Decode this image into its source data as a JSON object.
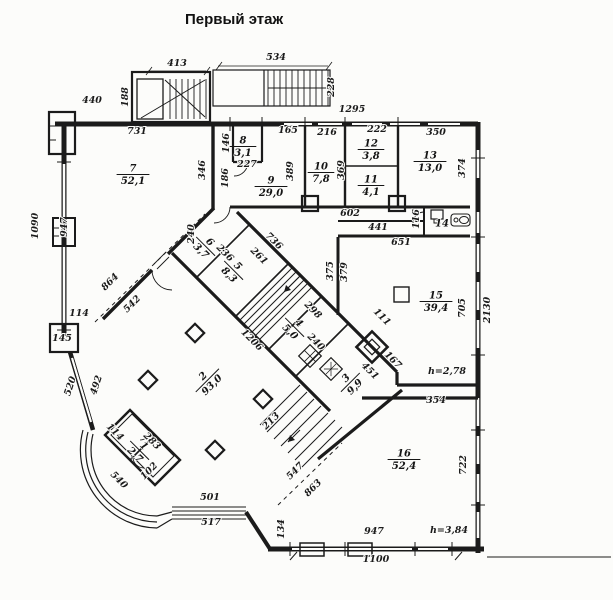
{
  "title": "Первый этаж",
  "plan": {
    "rooms": [
      {
        "num": "7",
        "area": "52,1",
        "x": 133,
        "y": 174,
        "r": 0
      },
      {
        "num": "8",
        "area": "3,1",
        "x": 243,
        "y": 146,
        "r": 0
      },
      {
        "num": "9",
        "area": "29,0",
        "x": 271,
        "y": 186,
        "r": 0
      },
      {
        "num": "10",
        "area": "7,8",
        "x": 321,
        "y": 172,
        "r": 0
      },
      {
        "num": "12",
        "area": "3,8",
        "x": 371,
        "y": 149,
        "r": 0
      },
      {
        "num": "11",
        "area": "4,1",
        "x": 371,
        "y": 185,
        "r": 0
      },
      {
        "num": "13",
        "area": "13,0",
        "x": 430,
        "y": 161,
        "r": 0
      },
      {
        "num": "14",
        "area": "",
        "x": 442,
        "y": 229,
        "r": 0
      },
      {
        "num": "15",
        "area": "39,4",
        "x": 436,
        "y": 301,
        "r": 0
      },
      {
        "num": "16",
        "area": "52,4",
        "x": 404,
        "y": 459,
        "r": 0
      },
      {
        "num": "6",
        "area": "3,7",
        "x": 206,
        "y": 246,
        "r": 45
      },
      {
        "num": "5",
        "area": "8,3",
        "x": 234,
        "y": 270,
        "r": 45
      },
      {
        "num": "4",
        "area": "5,0",
        "x": 295,
        "y": 327,
        "r": 45
      },
      {
        "num": "3",
        "area": "9,9",
        "x": 350,
        "y": 382,
        "r": -45
      },
      {
        "num": "2",
        "area": "93,0",
        "x": 207,
        "y": 380,
        "r": -45
      },
      {
        "num": "1",
        "area": "2,7",
        "x": 140,
        "y": 450,
        "r": 45
      }
    ],
    "dimensions": [
      {
        "t": "413",
        "x": 177,
        "y": 66,
        "r": 0
      },
      {
        "t": "188",
        "x": 128,
        "y": 97,
        "r": -90
      },
      {
        "t": "440",
        "x": 92,
        "y": 103,
        "r": 0
      },
      {
        "t": "534",
        "x": 276,
        "y": 60,
        "r": 0
      },
      {
        "t": "228",
        "x": 334,
        "y": 87,
        "r": -90
      },
      {
        "t": "1295",
        "x": 352,
        "y": 112,
        "r": 0
      },
      {
        "t": "731",
        "x": 137,
        "y": 134,
        "r": 0
      },
      {
        "t": "165",
        "x": 288,
        "y": 133,
        "r": 0
      },
      {
        "t": "216",
        "x": 327,
        "y": 135,
        "r": 0
      },
      {
        "t": "222",
        "x": 377,
        "y": 132,
        "r": 0
      },
      {
        "t": "350",
        "x": 436,
        "y": 135,
        "r": 0
      },
      {
        "t": "346",
        "x": 205,
        "y": 170,
        "r": -90
      },
      {
        "t": "146",
        "x": 229,
        "y": 143,
        "r": -90
      },
      {
        "t": "186",
        "x": 228,
        "y": 178,
        "r": -90
      },
      {
        "t": "227",
        "x": 247,
        "y": 167,
        "r": 0
      },
      {
        "t": "389",
        "x": 293,
        "y": 171,
        "r": -90
      },
      {
        "t": "369",
        "x": 344,
        "y": 170,
        "r": -90
      },
      {
        "t": "374",
        "x": 465,
        "y": 168,
        "r": -90
      },
      {
        "t": "602",
        "x": 350,
        "y": 216,
        "r": 0
      },
      {
        "t": "441",
        "x": 378,
        "y": 230,
        "r": 0
      },
      {
        "t": "651",
        "x": 401,
        "y": 245,
        "r": 0
      },
      {
        "t": "116",
        "x": 419,
        "y": 219,
        "r": -90
      },
      {
        "t": "375",
        "x": 333,
        "y": 271,
        "r": -90
      },
      {
        "t": "379",
        "x": 347,
        "y": 272,
        "r": -90
      },
      {
        "t": "1090",
        "x": 38,
        "y": 226,
        "r": -90
      },
      {
        "t": "947",
        "x": 67,
        "y": 227,
        "r": -90
      },
      {
        "t": "114",
        "x": 79,
        "y": 316,
        "r": 0
      },
      {
        "t": "145",
        "x": 62,
        "y": 341,
        "r": 0
      },
      {
        "t": "864",
        "x": 112,
        "y": 284,
        "r": -45
      },
      {
        "t": "542",
        "x": 134,
        "y": 306,
        "r": -45
      },
      {
        "t": "736",
        "x": 272,
        "y": 243,
        "r": 45
      },
      {
        "t": "240",
        "x": 194,
        "y": 234,
        "r": -90
      },
      {
        "t": "236",
        "x": 223,
        "y": 255,
        "r": 45
      },
      {
        "t": "261",
        "x": 257,
        "y": 258,
        "r": 45
      },
      {
        "t": "298",
        "x": 311,
        "y": 312,
        "r": 45
      },
      {
        "t": "240",
        "x": 314,
        "y": 344,
        "r": 45
      },
      {
        "t": "1206",
        "x": 250,
        "y": 342,
        "r": 45
      },
      {
        "t": "520",
        "x": 73,
        "y": 387,
        "r": -72
      },
      {
        "t": "492",
        "x": 99,
        "y": 386,
        "r": -72
      },
      {
        "t": "114",
        "x": 113,
        "y": 434,
        "r": 45
      },
      {
        "t": "283",
        "x": 150,
        "y": 443,
        "r": 45
      },
      {
        "t": "540",
        "x": 117,
        "y": 482,
        "r": 45
      },
      {
        "t": "102",
        "x": 151,
        "y": 473,
        "r": -45
      },
      {
        "t": "501",
        "x": 210,
        "y": 500,
        "r": 0
      },
      {
        "t": "517",
        "x": 211,
        "y": 525,
        "r": 0
      },
      {
        "t": "213",
        "x": 273,
        "y": 423,
        "r": -45
      },
      {
        "t": "547",
        "x": 297,
        "y": 473,
        "r": -45
      },
      {
        "t": "863",
        "x": 315,
        "y": 490,
        "r": -45
      },
      {
        "t": "134",
        "x": 284,
        "y": 529,
        "r": -90
      },
      {
        "t": "947",
        "x": 374,
        "y": 534,
        "r": 0
      },
      {
        "t": "1100",
        "x": 376,
        "y": 562,
        "r": 0
      },
      {
        "t": "h=3,84",
        "x": 449,
        "y": 533,
        "r": 0
      },
      {
        "t": "111",
        "x": 380,
        "y": 319,
        "r": 45
      },
      {
        "t": "167",
        "x": 391,
        "y": 362,
        "r": 45
      },
      {
        "t": "451",
        "x": 368,
        "y": 373,
        "r": 45
      },
      {
        "t": "h=2,78",
        "x": 447,
        "y": 374,
        "r": 0
      },
      {
        "t": "354",
        "x": 436,
        "y": 403,
        "r": 0
      },
      {
        "t": "705",
        "x": 465,
        "y": 308,
        "r": -90
      },
      {
        "t": "2130",
        "x": 490,
        "y": 310,
        "r": -90
      },
      {
        "t": "722",
        "x": 466,
        "y": 465,
        "r": -90
      }
    ]
  }
}
